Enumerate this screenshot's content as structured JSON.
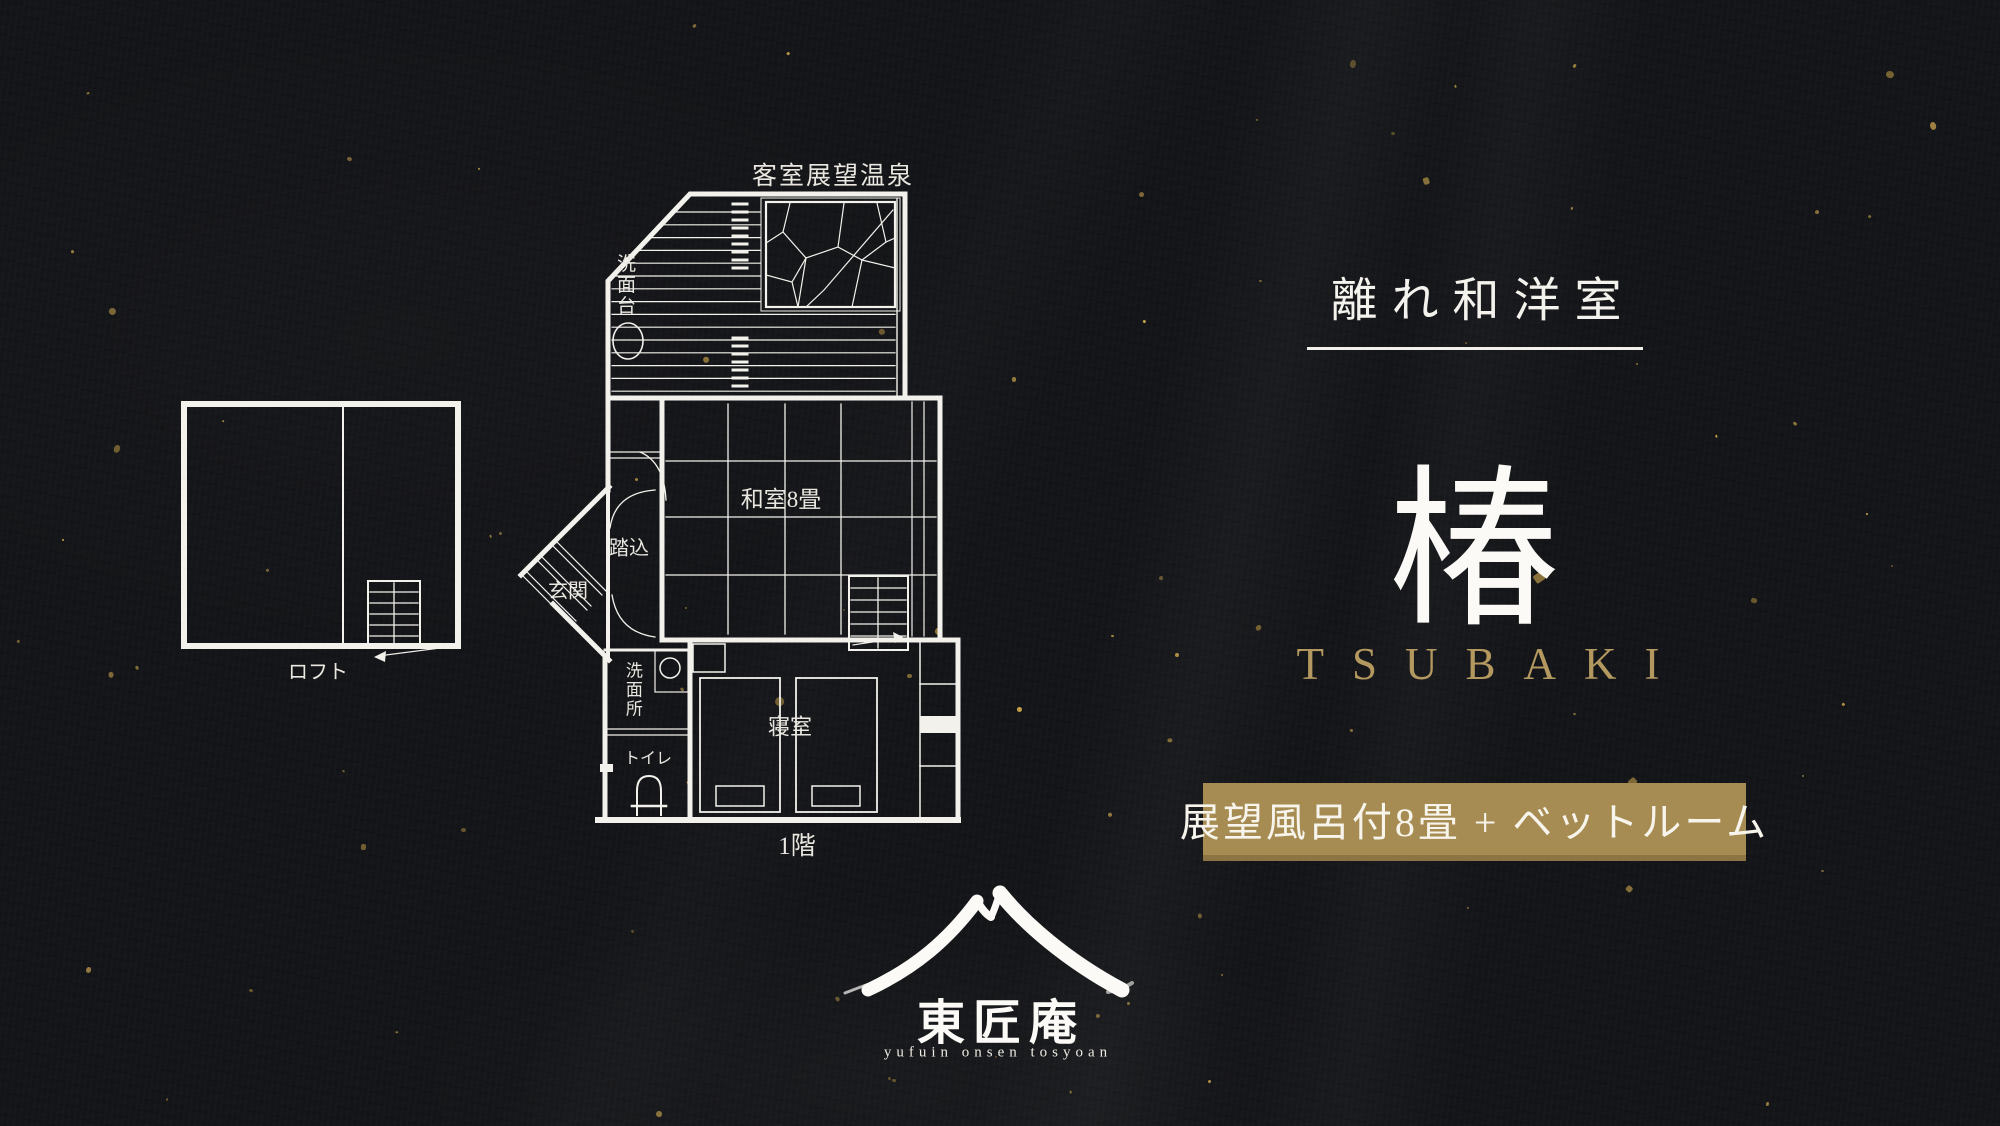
{
  "right_panel": {
    "category": "離れ和洋室",
    "room_name_kanji": "椿",
    "room_name_romaji": "TSUBAKI",
    "badge_label": "展望風呂付8畳 + ベットルーム"
  },
  "floor_plan": {
    "first_floor_label": "1階",
    "loft_label": "ロフト",
    "rooms": {
      "open_air_bath": "客室展望温泉",
      "washbasin": "洗面台",
      "japanese_room": "和室8畳",
      "step_in": "踏込",
      "entrance": "玄関",
      "washroom": "洗面所",
      "toilet": "トイレ",
      "bedroom": "寝室"
    }
  },
  "logo": {
    "name_calligraphy": "東匠庵",
    "tagline": "yufuin onsen tosyoan"
  },
  "colors": {
    "background": "#141518",
    "plan_line": "#f2f1ec",
    "gold_text": "#b3985f",
    "badge_background": "#a68c52",
    "badge_text": "#f7f4ec",
    "fleck_gold": "#c7a24b"
  }
}
